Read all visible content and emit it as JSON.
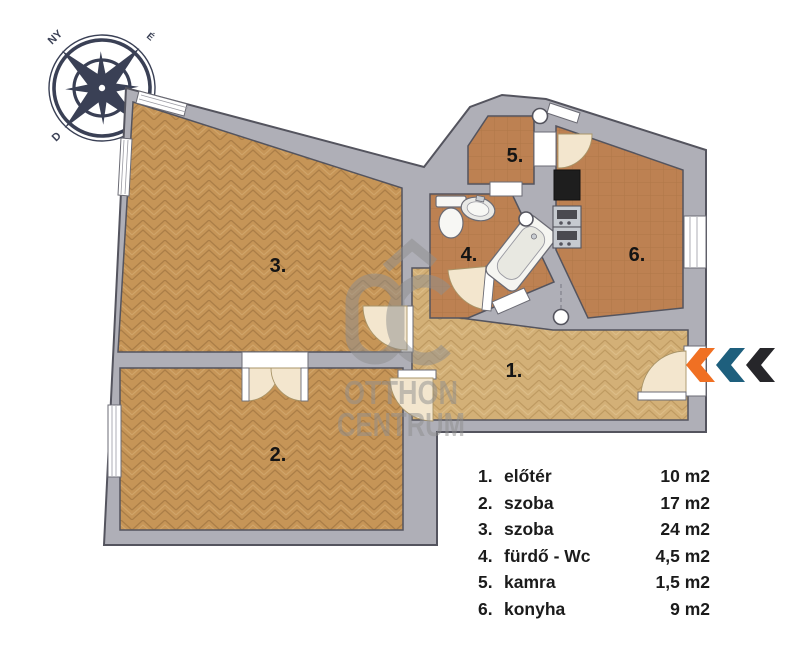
{
  "compass": {
    "west": "NY",
    "north": "É",
    "south": "D"
  },
  "watermark": {
    "line1": "OTTHON",
    "line2": "CENTRUM"
  },
  "plan": {
    "room_labels": [
      {
        "text": "1."
      },
      {
        "text": "2."
      },
      {
        "text": "3."
      },
      {
        "text": "4."
      },
      {
        "text": "5."
      },
      {
        "text": "6."
      }
    ]
  },
  "legend": {
    "items": [
      {
        "num": "1.",
        "label": "előtér",
        "area": "10 m2"
      },
      {
        "num": "2.",
        "label": "szoba",
        "area": "17 m2"
      },
      {
        "num": "3.",
        "label": "szoba",
        "area": "24 m2"
      },
      {
        "num": "4.",
        "label": "fürdő - Wc",
        "area": "4,5 m2"
      },
      {
        "num": "5.",
        "label": "kamra",
        "area": "1,5 m2"
      },
      {
        "num": "6.",
        "label": "konyha",
        "area": "9 m2"
      }
    ]
  },
  "colors": {
    "wall": "#AFAFB7",
    "wall_outline": "#54545E",
    "parquet": "#C69557",
    "parquet_light": "#D3B077",
    "tile": "#BD8152",
    "door_arc": "#F3E6CE",
    "chevron_orange": "#F07023",
    "chevron_teal": "#1E5F7D",
    "chevron_black": "#26262A",
    "compass": "#3A4055"
  }
}
